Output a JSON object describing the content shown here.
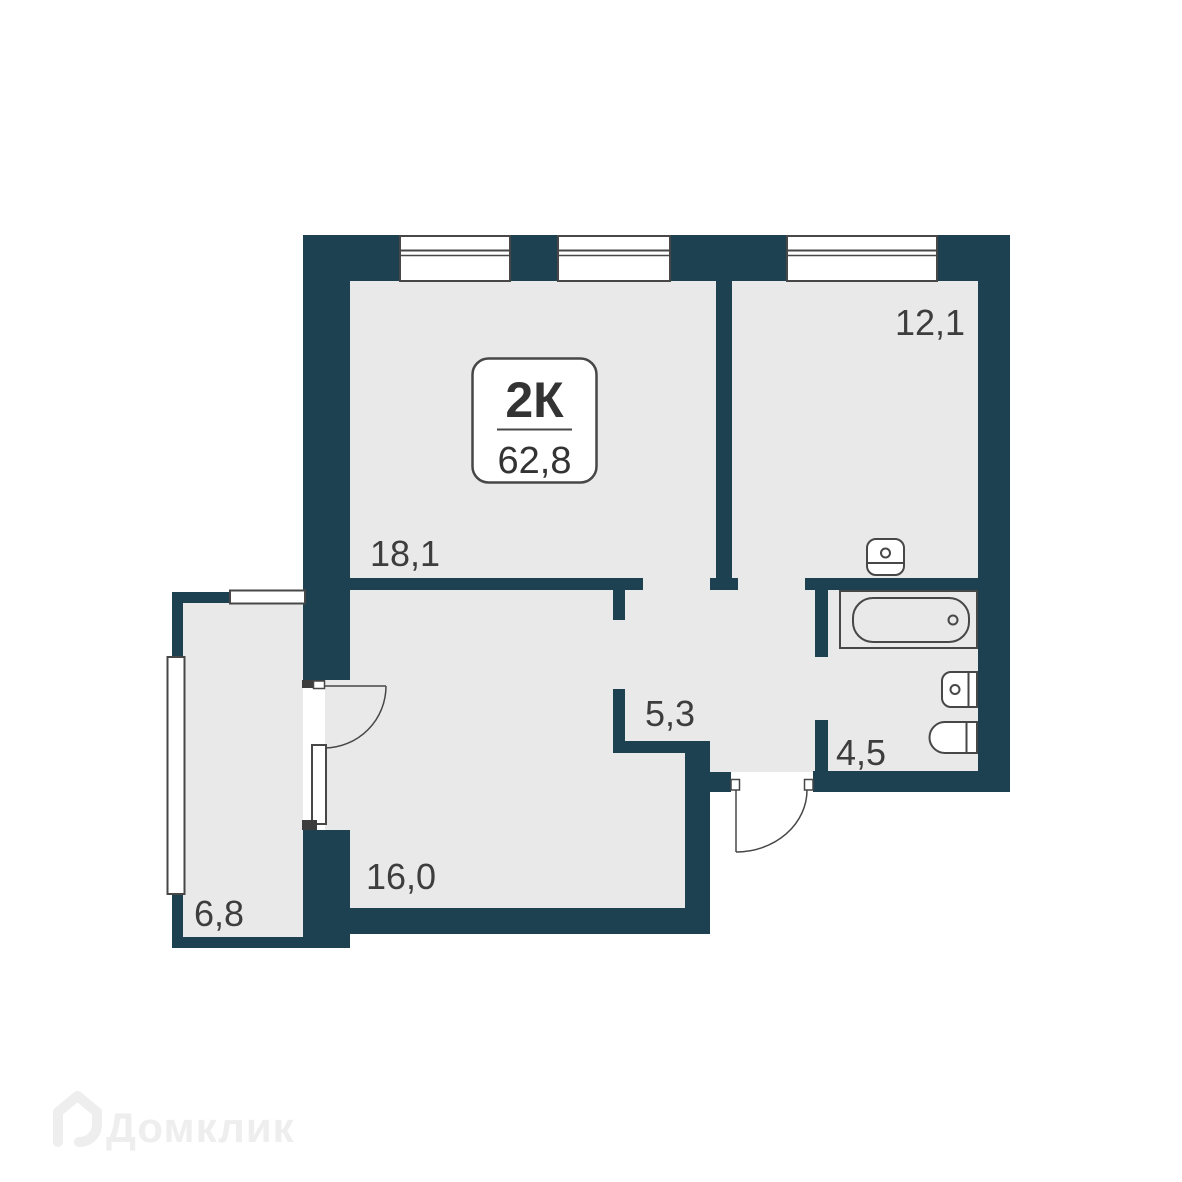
{
  "badge": {
    "type": "2К",
    "area": "62,8"
  },
  "rooms": {
    "living": "18,1",
    "bedroom": "12,1",
    "hallway": "5,3",
    "bathroom": "4,5",
    "kitchen_living": "16,0",
    "balcony": "6,8"
  },
  "watermark": {
    "brand": "Домклик"
  },
  "colors": {
    "wall": "#1e4151",
    "floor": "#e9e9e9",
    "line": "#474747",
    "text": "#3d3d3d",
    "threshold": "#3d3d3d",
    "badgetext": "#333333",
    "watermark": "#eeeeee",
    "background": "#ffffff"
  }
}
